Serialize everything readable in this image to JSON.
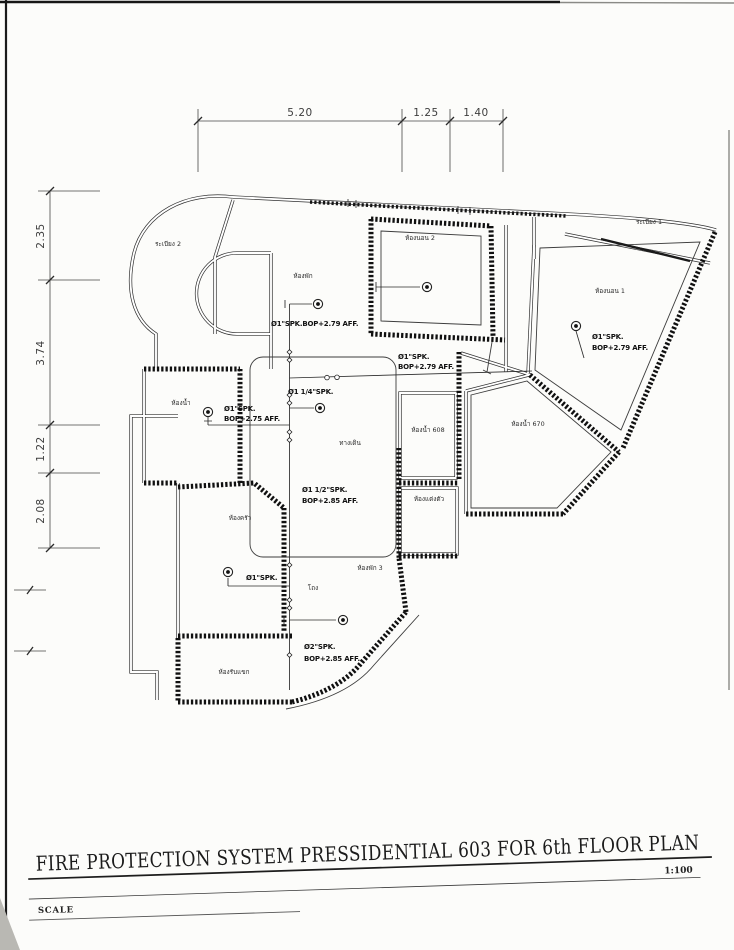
{
  "document": {
    "title": "FIRE PROTECTION SYSTEM PRESSIDENTIAL 603 FOR 6th FLOOR PLAN",
    "scale_ratio": "1:100",
    "scale_label": "SCALE"
  },
  "dimensions": {
    "top": [
      "5.20",
      "1.25",
      "1.40"
    ],
    "left": [
      "2.35",
      "3.74",
      "1.22",
      "2.08"
    ]
  },
  "rooms": [
    {
      "label": "ระเบียง 2"
    },
    {
      "label": "ห้องพัก"
    },
    {
      "label": "ห้องนอน 2"
    },
    {
      "label": "ระเบียง 1"
    },
    {
      "label": "ห้องนอน 1"
    },
    {
      "label": "ห้องน้ำ"
    },
    {
      "label": "ทางเดิน"
    },
    {
      "label": "ห้องน้ำ 608"
    },
    {
      "label": "ห้องน้ำ 670"
    },
    {
      "label": "ห้องแต่งตัว"
    },
    {
      "label": "ห้องครัว"
    },
    {
      "label": "ห้องพัก 3"
    },
    {
      "label": "โถง"
    },
    {
      "label": "ห้องรับแขก"
    }
  ],
  "annotations": [
    {
      "lines": [
        "Ø1\"SPK.BOP+2.79 AFF."
      ]
    },
    {
      "lines": [
        "Ø1\"SPK.",
        "BOP+2.79 AFF."
      ]
    },
    {
      "lines": [
        "Ø1 1/4\"SPK."
      ]
    },
    {
      "lines": [
        "Ø1\"SPK.",
        "BOP+2.75 AFF."
      ]
    },
    {
      "lines": [
        "Ø1 1/2\"SPK.",
        "BOP+2.85 AFF."
      ]
    },
    {
      "lines": [
        "Ø1\"SPK.",
        "BOP+2.79 AFF."
      ]
    },
    {
      "lines": [
        "Ø1\"SPK."
      ]
    },
    {
      "lines": [
        "Ø2\"SPK.",
        "BOP+2.85 AFF."
      ]
    }
  ],
  "colors": {
    "ink": "#1d1d1d",
    "paper": "#fcfcfa"
  }
}
